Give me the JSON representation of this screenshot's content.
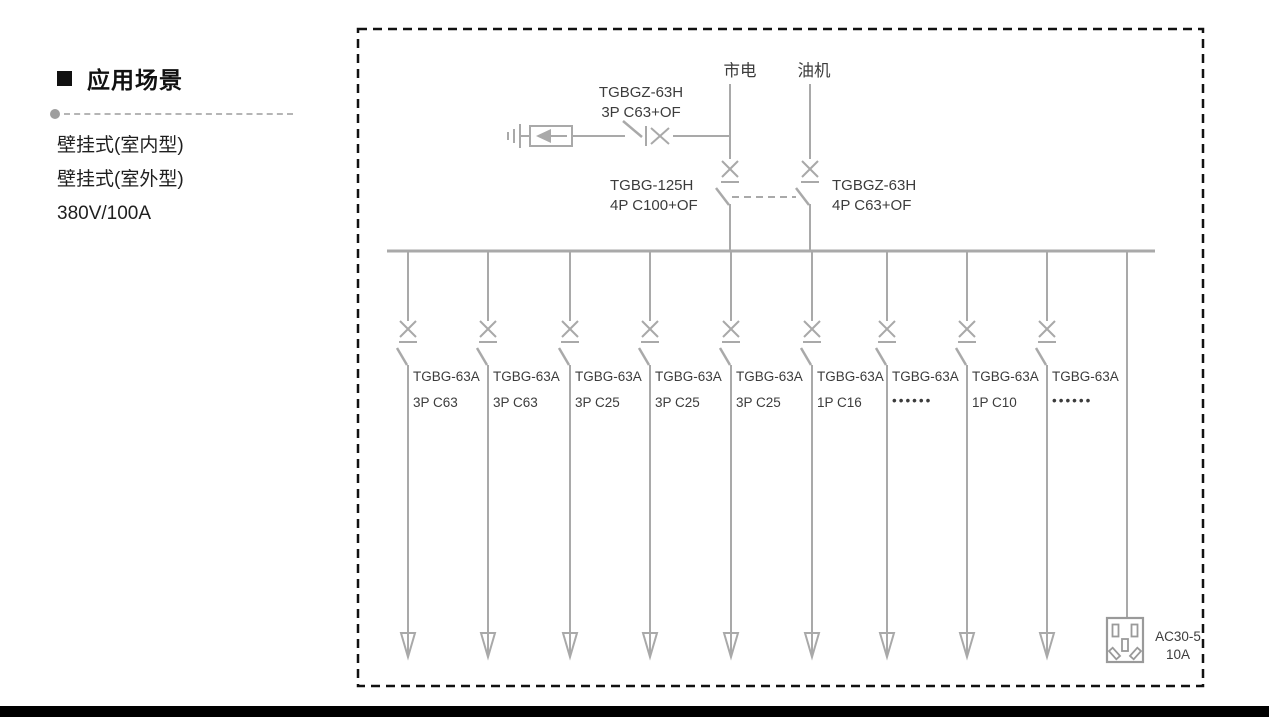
{
  "page": {
    "section_title": "应用场景",
    "features": [
      "壁挂式(室内型)",
      "壁挂式(室外型)",
      "380V/100A"
    ]
  },
  "diagram": {
    "source_mains_label": "市电",
    "source_generator_label": "油机",
    "spd_branch_breaker": {
      "model": "TGBGZ-63H",
      "spec": "3P C63+OF"
    },
    "mains_breaker": {
      "model": "TGBG-125H",
      "spec": "4P C100+OF"
    },
    "generator_breaker": {
      "model": "TGBGZ-63H",
      "spec": "4P C63+OF"
    },
    "branches": [
      {
        "model": "TGBG-63A",
        "spec": "3P C63"
      },
      {
        "model": "TGBG-63A",
        "spec": "3P C63"
      },
      {
        "model": "TGBG-63A",
        "spec": "3P C25"
      },
      {
        "model": "TGBG-63A",
        "spec": "3P C25"
      },
      {
        "model": "TGBG-63A",
        "spec": "3P C25"
      },
      {
        "model": "TGBG-63A",
        "spec": "1P C16"
      },
      {
        "model": "TGBG-63A",
        "spec": "••••••"
      },
      {
        "model": "TGBG-63A",
        "spec": "1P C10"
      },
      {
        "model": "TGBG-63A",
        "spec": "••••••"
      }
    ],
    "socket": {
      "model": "AC30-5",
      "rating": "10A"
    }
  },
  "colors": {
    "line": "#a9a9a9",
    "text": "#3c3c3c",
    "border": "#000000"
  }
}
